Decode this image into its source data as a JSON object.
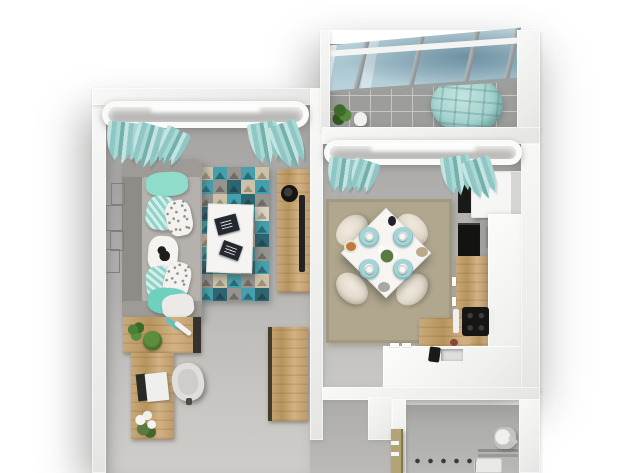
{
  "meta": {
    "description": "Top-down 3D render of a studio apartment floor plan with living room, glazed balcony, kitchen-dining area, hallway and bathroom",
    "view": "top-down-3d",
    "visible_text": []
  },
  "palette": {
    "background": "#ffffff",
    "wall_white": "#f1f1ef",
    "floor_gray": "#b7b5b2",
    "balcony_tile": "#9d9d9b",
    "wood": "#c3a172",
    "teal_textile": "#9fd2ce",
    "mint": "#8fdcc9",
    "sofa_gray": "#a6a29d",
    "white_furniture": "#f6f5f3",
    "dark_appliance": "#1b1b19",
    "appliance_gray": "#9e9d9b",
    "glass_blue": "#b0ccd6",
    "dining_rug": "#b1a78e",
    "plate_teal": "#8cc8cb",
    "chair_cream": "#e5dfd3",
    "plant_green": "#4a7a30",
    "bath_door_tan": "#b3a476",
    "tv_black": "#222222"
  },
  "rooms": {
    "living_room": {
      "label": "living-room",
      "items": [
        "window-with-curtains",
        "floor-lamp",
        "sofa-with-pillows",
        "geometric-area-rug",
        "coffee-table",
        "books",
        "tv-console",
        "speaker",
        "tv-panel",
        "wall-frames",
        "sideboard",
        "plants",
        "writing-desk",
        "laptop",
        "office-chair",
        "vase-with-flowers"
      ]
    },
    "balcony": {
      "label": "glazed-balcony",
      "items": [
        "sloped-glass-roof",
        "tile-floor",
        "round-pouf",
        "potted-plant",
        "watering-can"
      ]
    },
    "kitchen_dining": {
      "label": "kitchen-dining",
      "items": [
        "window-with-curtains",
        "refrigerator",
        "tall-dark-cabinet",
        "oven",
        "microwave-with-handle",
        "l-shaped-white-counter",
        "wood-countertop",
        "cooktop",
        "sink-with-faucet",
        "dining-table",
        "dining-chairs",
        "place-settings",
        "flower-centerpiece",
        "dining-rug"
      ]
    },
    "hallway": {
      "label": "hallway",
      "items": [
        "wardrobe"
      ]
    },
    "bathroom": {
      "label": "bathroom",
      "items": [
        "washing-machine",
        "wall-hooks",
        "plumbing-fixtures",
        "open-door"
      ]
    }
  },
  "living_rug": {
    "cols": 5,
    "rows": 10,
    "colors": {
      "teal": [
        "#44a0ad",
        "#27606c"
      ],
      "gray": [
        "#96948f",
        "#67655f"
      ],
      "tan": [
        "#ccc2a9",
        "#938972"
      ],
      "dark": [
        "#2f6570",
        "#1c4751"
      ],
      "light": [
        "#d9d3c3",
        "#a09782"
      ]
    },
    "cells": [
      "tan",
      "teal",
      "gray",
      "teal",
      "tan",
      "teal",
      "gray",
      "dark",
      "tan",
      "teal",
      "gray",
      "tan",
      "teal",
      "dark",
      "gray",
      "dark",
      "teal",
      "tan",
      "teal",
      "light",
      "teal",
      "light",
      "dark",
      "gray",
      "teal",
      "tan",
      "dark",
      "teal",
      "tan",
      "dark",
      "teal",
      "gray",
      "light",
      "teal",
      "gray",
      "dark",
      "teal",
      "tan",
      "dark",
      "teal",
      "gray",
      "tan",
      "teal",
      "gray",
      "tan",
      "teal",
      "dark",
      "gray",
      "teal",
      "dark"
    ]
  },
  "dining_set": {
    "chairs": 4,
    "place_settings": 4,
    "centerpiece": "white-flowers"
  }
}
